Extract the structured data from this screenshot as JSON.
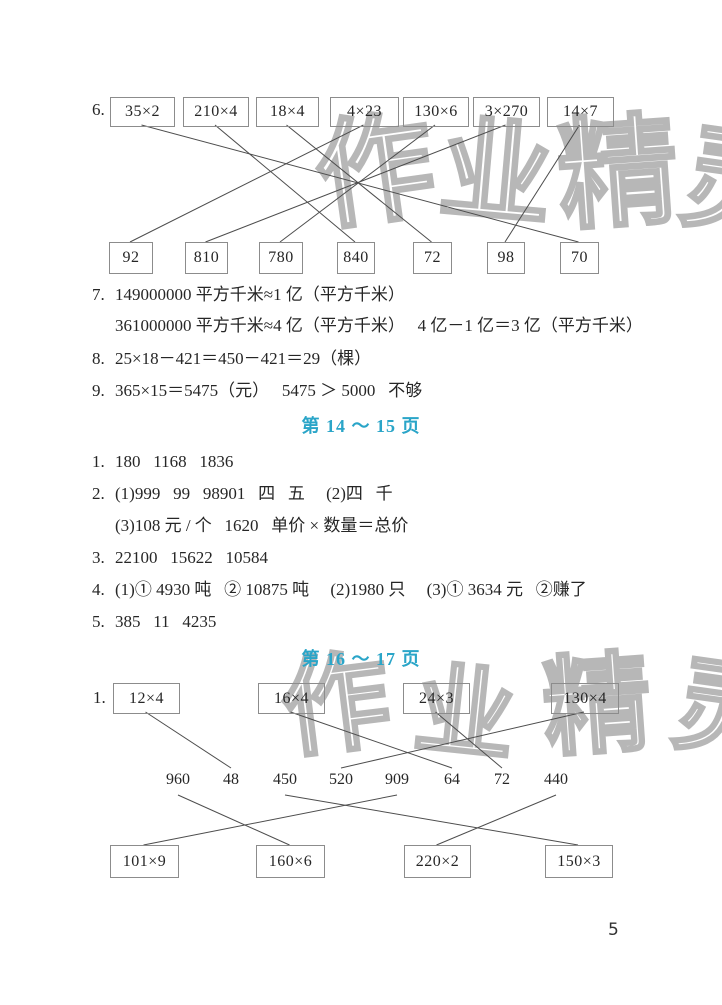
{
  "watermark": {
    "chars": [
      "作",
      "业",
      "精",
      "灵"
    ]
  },
  "exercise6": {
    "label": "6.",
    "top_boxes": [
      "35×2",
      "210×4",
      "18×4",
      "4×23",
      "130×6",
      "3×270",
      "14×7"
    ],
    "bottom_boxes": [
      "92",
      "810",
      "780",
      "840",
      "72",
      "98",
      "70"
    ],
    "matches": {
      "35×2": "70",
      "210×4": "840",
      "18×4": "72",
      "4×23": "92",
      "130×6": "780",
      "3×270": "810",
      "14×7": "98"
    }
  },
  "problems_7_9": [
    {
      "label": "7.",
      "lines": [
        "149000000 平方千米≈1 亿（平方千米）",
        "361000000 平方千米≈4 亿（平方千米）   4 亿－1 亿＝3 亿（平方千米）"
      ]
    },
    {
      "label": "8.",
      "lines": [
        "25×18－421＝450－421＝29（棵）"
      ]
    },
    {
      "label": "9.",
      "lines": [
        "365×15＝5475（元）   5475 ＞ 5000   不够"
      ]
    }
  ],
  "section_14_15": {
    "title": "第 14 ～ 15 页",
    "title_color": "#2aa5c8",
    "problems": [
      {
        "label": "1.",
        "lines": [
          "180   1168   1836"
        ]
      },
      {
        "label": "2.",
        "lines": [
          "(1)999   99   98901   四   五     (2)四   千",
          "(3)108 元 / 个   1620   单价 × 数量＝总价"
        ]
      },
      {
        "label": "3.",
        "lines": [
          "22100   15622   10584"
        ]
      },
      {
        "label": "4.",
        "lines": [
          "(1)① 4930 吨   ② 10875 吨     (2)1980 只     (3)① 3634 元   ②赚了"
        ]
      },
      {
        "label": "5.",
        "lines": [
          "385   11   4235"
        ]
      }
    ]
  },
  "section_16_17": {
    "title": "第 16 ～ 17 页",
    "exercise1": {
      "label": "1.",
      "top_boxes": [
        "12×4",
        "16×4",
        "24×3",
        "130×4"
      ],
      "middle_numbers": [
        "960",
        "48",
        "450",
        "520",
        "909",
        "64",
        "72",
        "440"
      ],
      "bottom_boxes": [
        "101×9",
        "160×6",
        "220×2",
        "150×3"
      ],
      "matches_top": {
        "12×4": "48",
        "16×4": "64",
        "24×3": "72",
        "130×4": "520"
      },
      "matches_bottom": {
        "101×9": "909",
        "160×6": "960",
        "220×2": "440",
        "150×3": "450"
      }
    }
  },
  "page_number": "5"
}
